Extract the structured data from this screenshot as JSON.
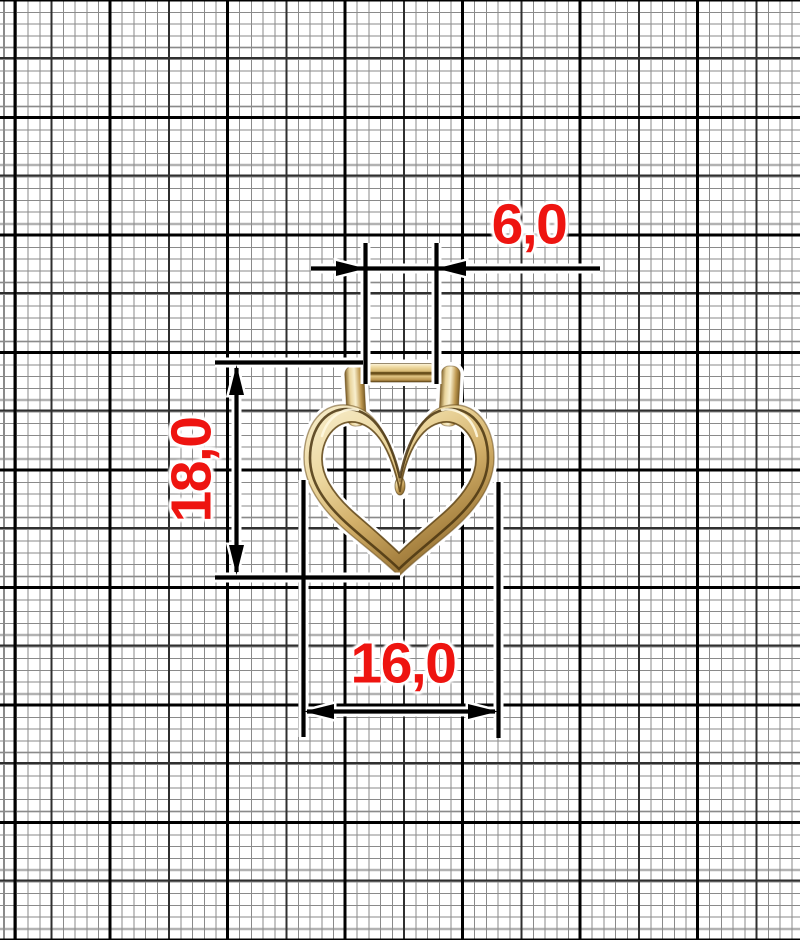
{
  "drawing": {
    "title": "Heart pendant dimensioned drawing",
    "subject": "open-heart-pendant",
    "paper": "millimeter-graph-paper",
    "labels": {
      "bail_width": "6,0",
      "height": "18,0",
      "width": "16,0"
    },
    "colors": {
      "dimension_text": "#ee1410",
      "dimension_line": "#000000",
      "paper": "#ffffff",
      "grid_heavy": "#000000",
      "grid_medium": "#2f2f2f",
      "grid_fine": "#8a8a8a",
      "gold_light": "#f8efce",
      "gold_mid": "#d3b06a",
      "gold_dark": "#8d6c31"
    }
  }
}
